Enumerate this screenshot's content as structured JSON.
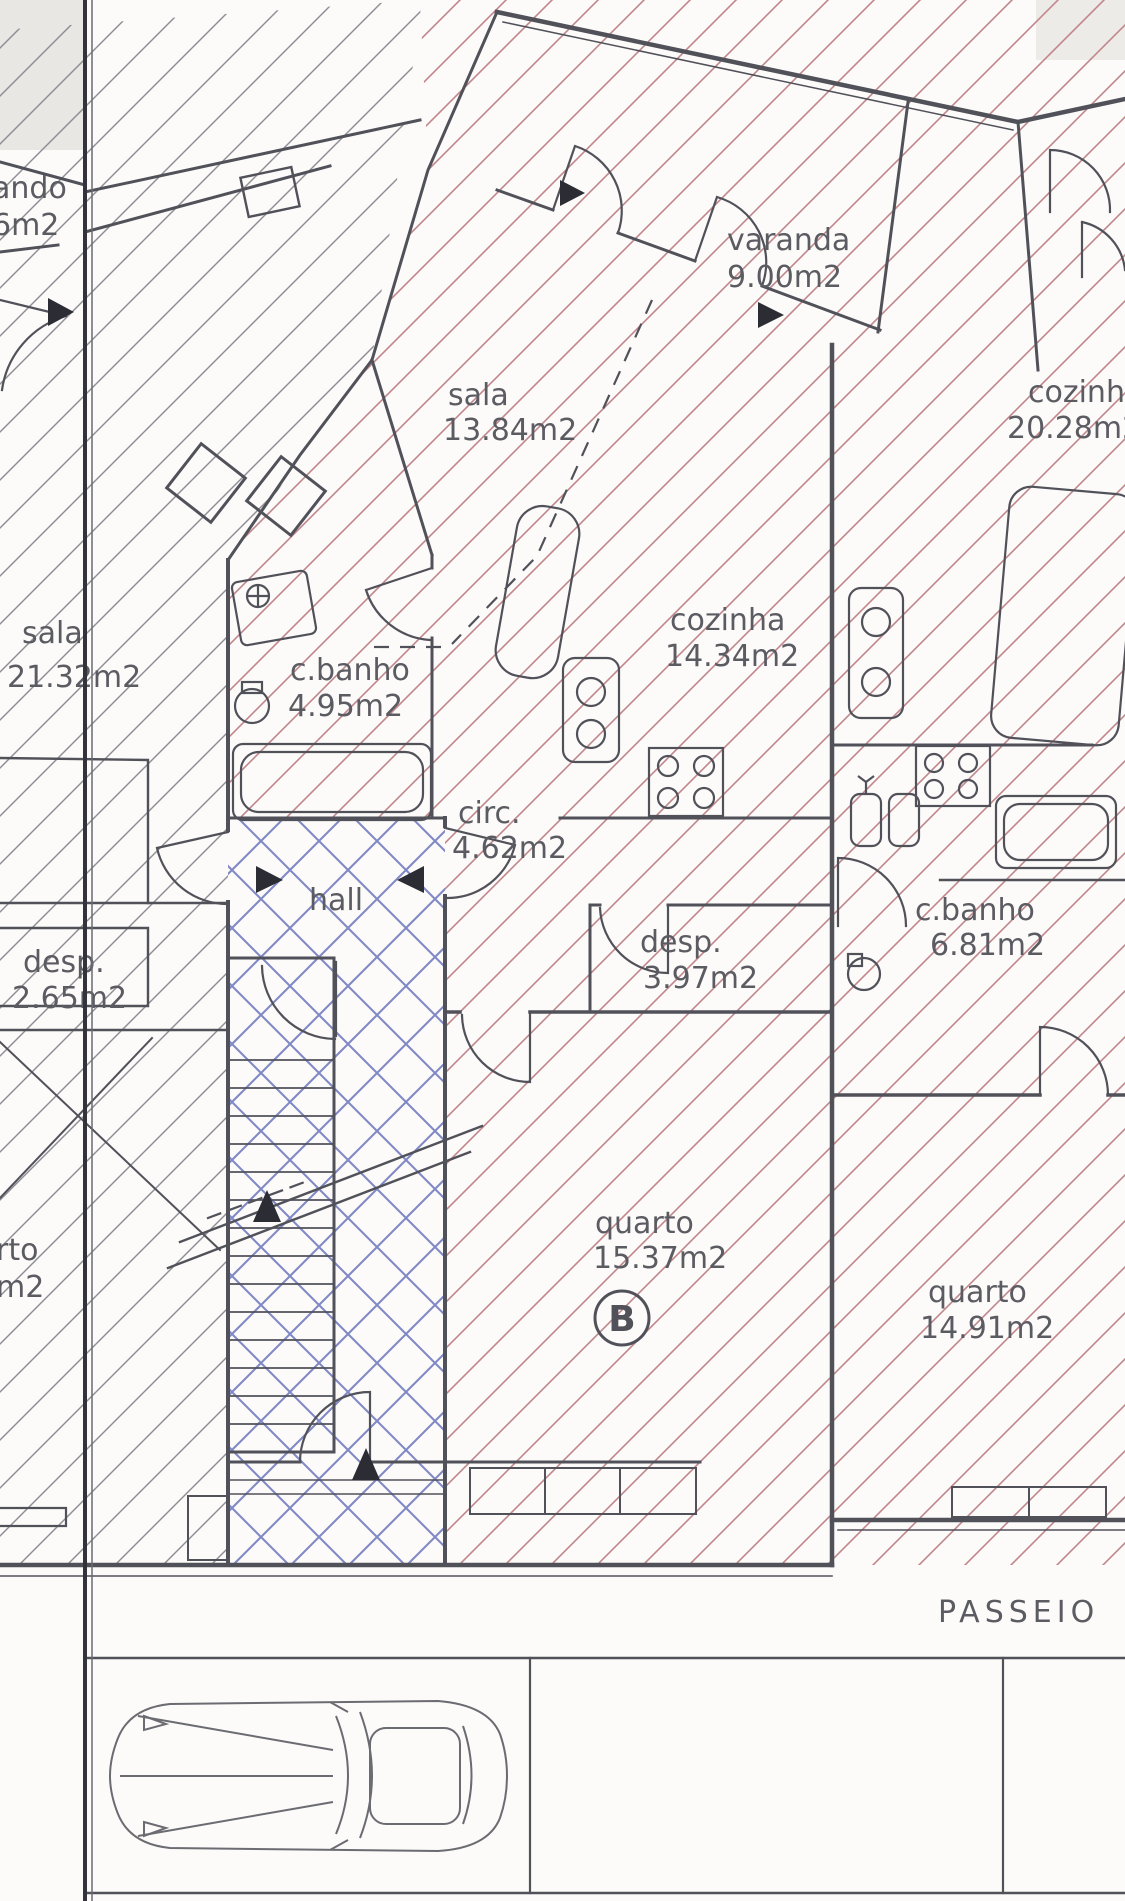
{
  "plan": {
    "unit_b": {
      "varanda": {
        "name": "varanda",
        "area": "9.00m2"
      },
      "sala": {
        "name": "sala",
        "area": "13.84m2"
      },
      "cozinha": {
        "name": "cozinha",
        "area": "14.34m2"
      },
      "cbanho": {
        "name": "c.banho",
        "area": "4.95m2"
      },
      "circ": {
        "name": "circ.",
        "area": "4.62m2"
      },
      "hall": {
        "name": "hall"
      },
      "desp": {
        "name": "desp.",
        "area": "3.97m2"
      },
      "quarto": {
        "name": "quarto",
        "area": "15.37m2"
      },
      "unit_letter": "B"
    },
    "unit_right": {
      "cozinha": {
        "name": "cozinha",
        "area": "20.28m2"
      },
      "cbanho": {
        "name": "c.banho",
        "area": "6.81m2"
      },
      "quarto": {
        "name": "quarto",
        "area": "14.91m2"
      }
    },
    "unit_left": {
      "varanda_fragment": {
        "line1": "ando",
        "line2": "6m2"
      },
      "sala": {
        "name": "sala",
        "area": "21.32m2"
      },
      "desp": {
        "name": "desp.",
        "area": "2.65m2"
      },
      "quarto_fragment": {
        "line1": "rto",
        "line2": "m2"
      }
    },
    "street": {
      "sidewalk_label": "PASSEIO"
    }
  },
  "colors": {
    "hatch_red": "#c0868c",
    "hatch_blue": "#8089c6",
    "hatch_gray": "#8f8f95",
    "wall": "#51515a",
    "text": "#5b5b62"
  }
}
